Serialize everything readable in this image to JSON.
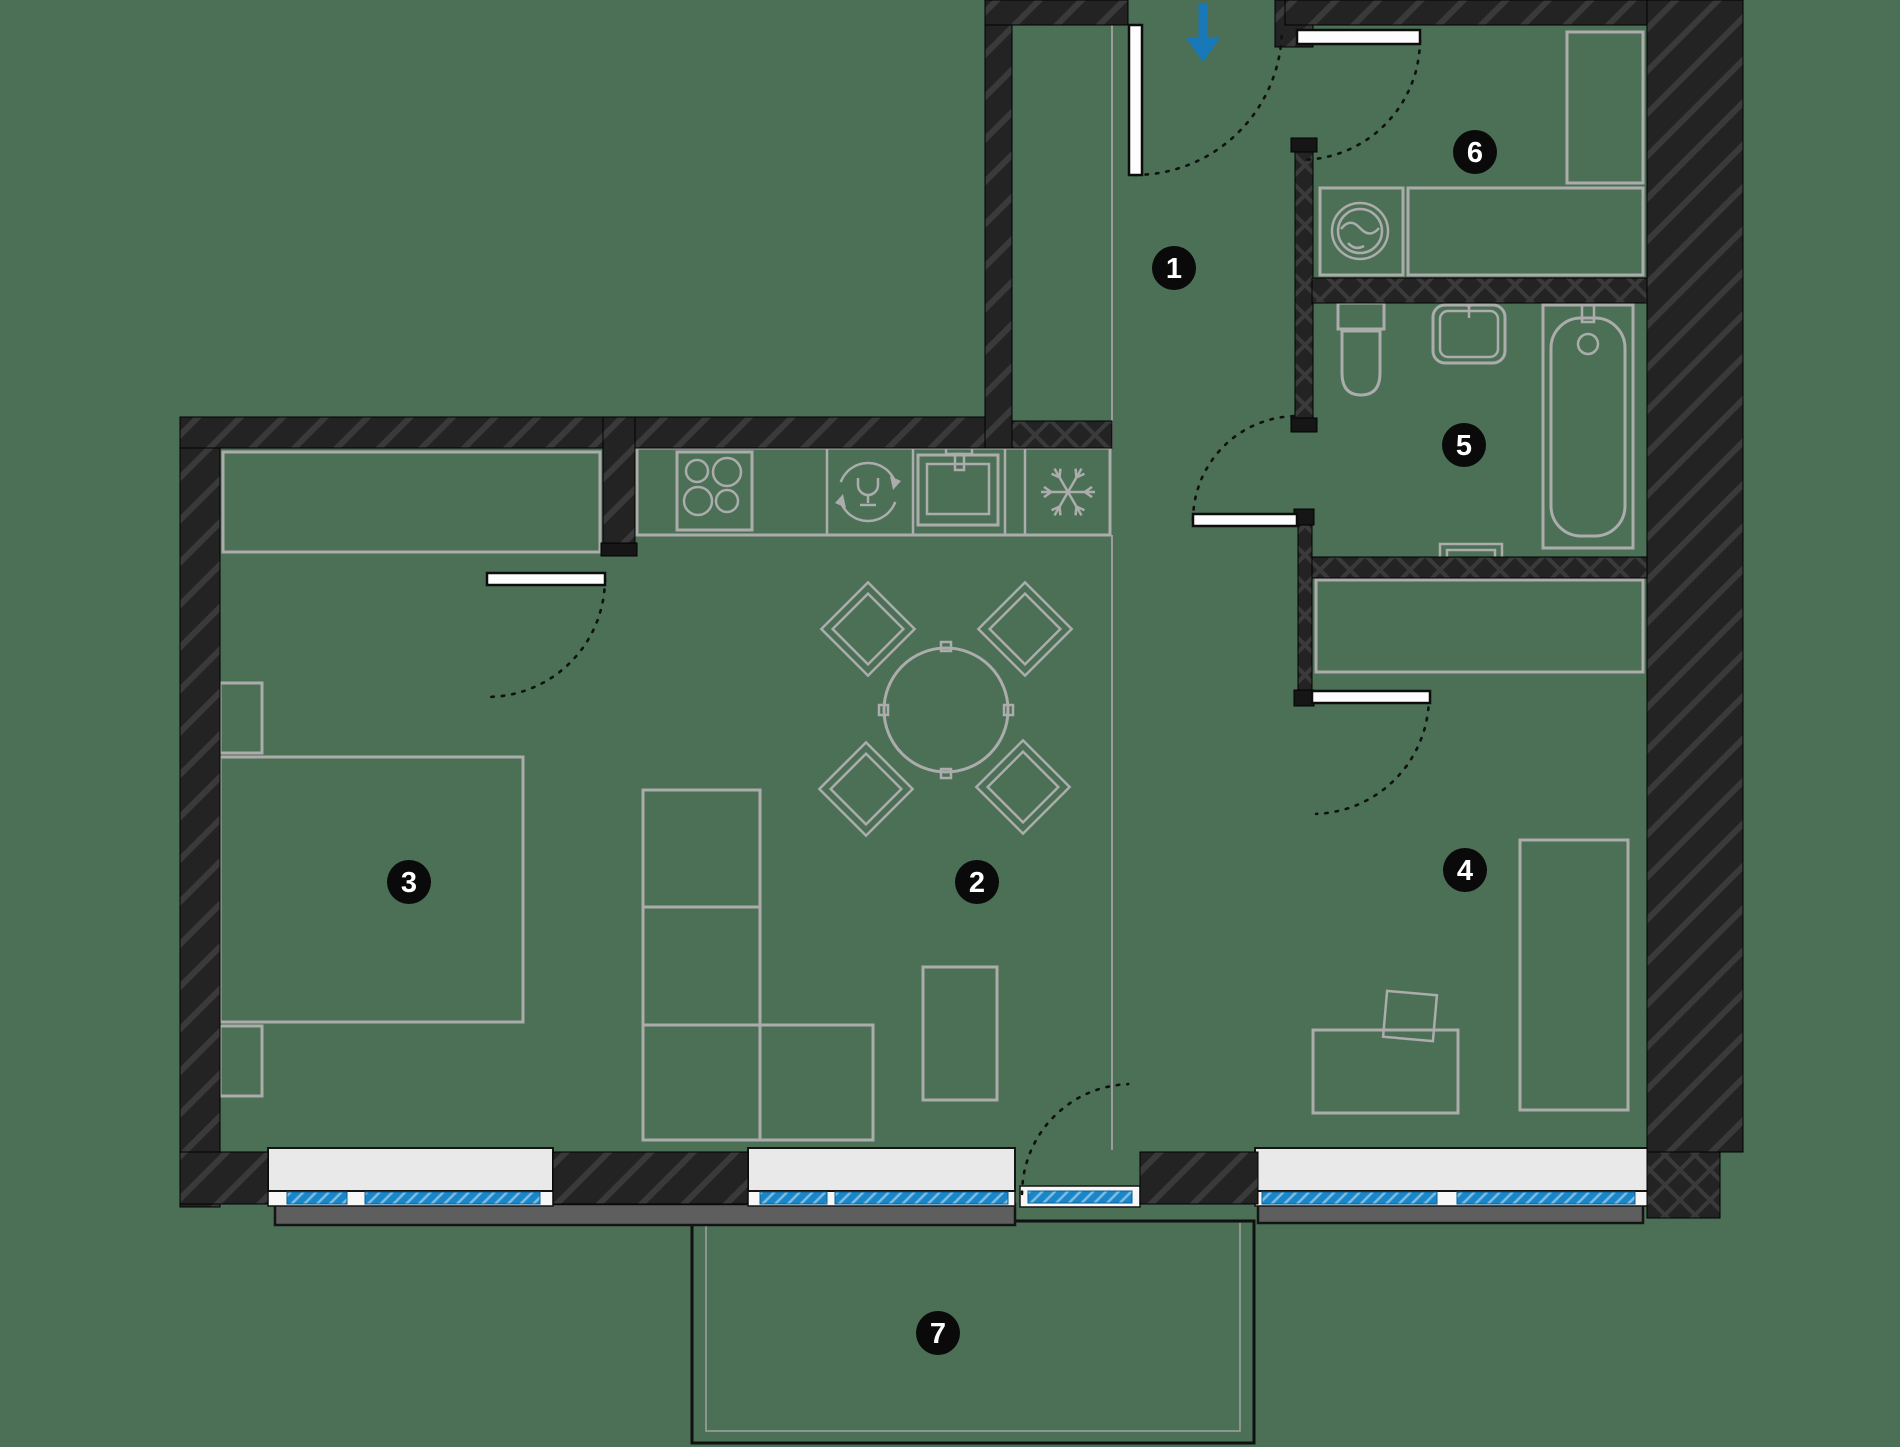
{
  "canvas": {
    "width": 1900,
    "height": 1447,
    "background": "#4b7056"
  },
  "palette": {
    "floor": "#4b7056",
    "wall": "#232323",
    "wall_hatch": "#3a3a3a",
    "furniture": "#abacab",
    "glass_blue": "#1886c9",
    "sill_inner": "#e9e9e9",
    "sill_outer": "#5e5e5e",
    "badge": "#0a0a0a",
    "badge_text": "#ffffff",
    "arrow_blue": "#1878b8"
  },
  "badges": [
    {
      "label": "1",
      "x": 1174,
      "y": 268
    },
    {
      "label": "2",
      "x": 977,
      "y": 882
    },
    {
      "label": "3",
      "x": 409,
      "y": 882
    },
    {
      "label": "4",
      "x": 1465,
      "y": 870
    },
    {
      "label": "5",
      "x": 1464,
      "y": 445
    },
    {
      "label": "6",
      "x": 1475,
      "y": 152
    },
    {
      "label": "7",
      "x": 938,
      "y": 1333
    }
  ],
  "floor_lines": [
    {
      "n": "floor-zone-line",
      "c": "zline",
      "x1": 1112,
      "y1": 25,
      "x2": 1112,
      "y2": 448
    },
    {
      "n": "floor-zone-line",
      "c": "zline",
      "x1": 1112,
      "y1": 535,
      "x2": 1112,
      "y2": 1150
    }
  ],
  "furniture": [
    {
      "n": "wardrobe",
      "c": "furn",
      "x": 223,
      "y": 452,
      "w": 377,
      "h": 100
    },
    {
      "n": "bed",
      "c": "furn",
      "x": 220,
      "y": 757,
      "w": 303,
      "h": 265
    },
    {
      "n": "nightstand",
      "c": "furn",
      "x": 220,
      "y": 683,
      "w": 42,
      "h": 70
    },
    {
      "n": "nightstand",
      "c": "furn",
      "x": 220,
      "y": 1026,
      "w": 42,
      "h": 70
    },
    {
      "n": "kitchen-counter",
      "c": "furn",
      "x": 637,
      "y": 448,
      "w": 473,
      "h": 87
    },
    {
      "n": "counter-divider",
      "c": "furn2",
      "x1": 827,
      "y1": 448,
      "x2": 827,
      "y2": 535
    },
    {
      "n": "counter-divider",
      "c": "furn2",
      "x1": 913,
      "y1": 448,
      "x2": 913,
      "y2": 535
    },
    {
      "n": "counter-divider",
      "c": "furn2",
      "x1": 1005,
      "y1": 448,
      "x2": 1005,
      "y2": 535
    },
    {
      "n": "counter-divider",
      "c": "furn2",
      "x1": 1025,
      "y1": 448,
      "x2": 1025,
      "y2": 535
    },
    {
      "n": "stove",
      "c": "furn",
      "x": 677,
      "y": 452,
      "w": 75,
      "h": 78
    },
    {
      "n": "burner-icon",
      "c": "furn2",
      "cx": 697,
      "cy": 471,
      "r": 11
    },
    {
      "n": "burner-icon",
      "c": "furn2",
      "cx": 727,
      "cy": 472,
      "r": 14
    },
    {
      "n": "burner-icon",
      "c": "furn2",
      "cx": 698,
      "cy": 501,
      "r": 14
    },
    {
      "n": "burner-icon",
      "c": "furn2",
      "cx": 727,
      "cy": 501,
      "r": 11
    },
    {
      "n": "kitchen-sink",
      "c": "furn",
      "x": 918,
      "y": 455,
      "w": 80,
      "h": 70
    },
    {
      "n": "kitchen-sink-basin",
      "c": "furn2",
      "x": 927,
      "y": 464,
      "w": 62,
      "h": 50
    },
    {
      "n": "faucet-icon",
      "c": "furn2",
      "x": 946,
      "y": 446,
      "w": 26,
      "h": 8
    },
    {
      "n": "faucet-icon",
      "c": "furn2",
      "x": 955,
      "y": 454,
      "w": 9,
      "h": 16
    },
    {
      "n": "dining-table",
      "c": "furn",
      "cx": 946,
      "cy": 710,
      "r": 62
    },
    {
      "n": "table-tab",
      "c": "furn2",
      "x": 941,
      "y": 642,
      "w": 10,
      "h": 9
    },
    {
      "n": "table-tab",
      "c": "furn2",
      "x": 941,
      "y": 769,
      "w": 10,
      "h": 9
    },
    {
      "n": "table-tab",
      "c": "furn2",
      "x": 879,
      "y": 705,
      "w": 9,
      "h": 10
    },
    {
      "n": "table-tab",
      "c": "furn2",
      "x": 1004,
      "y": 705,
      "w": 9,
      "h": 10
    },
    {
      "n": "chair",
      "c": "furn2",
      "cx": 868,
      "cy": 629,
      "w": 66,
      "h": 66,
      "rot": 45
    },
    {
      "n": "chair",
      "c": "furn2",
      "cx": 868,
      "cy": 629,
      "w": 50,
      "h": 50,
      "rot": 45
    },
    {
      "n": "chair",
      "c": "furn2",
      "cx": 1025,
      "cy": 629,
      "w": 66,
      "h": 66,
      "rot": 45
    },
    {
      "n": "chair",
      "c": "furn2",
      "cx": 1025,
      "cy": 629,
      "w": 50,
      "h": 50,
      "rot": 45
    },
    {
      "n": "chair",
      "c": "furn2",
      "cx": 866,
      "cy": 789,
      "w": 66,
      "h": 66,
      "rot": 45
    },
    {
      "n": "chair",
      "c": "furn2",
      "cx": 866,
      "cy": 789,
      "w": 50,
      "h": 50,
      "rot": 45
    },
    {
      "n": "chair",
      "c": "furn2",
      "cx": 1023,
      "cy": 787,
      "w": 66,
      "h": 66,
      "rot": 45
    },
    {
      "n": "chair",
      "c": "furn2",
      "cx": 1023,
      "cy": 787,
      "w": 50,
      "h": 50,
      "rot": 45
    },
    {
      "n": "shelf-unit",
      "c": "furn",
      "x": 643,
      "y": 790,
      "w": 117,
      "h": 117
    },
    {
      "n": "shelf-unit",
      "c": "furn",
      "x": 643,
      "y": 907,
      "w": 117,
      "h": 118
    },
    {
      "n": "shelf-unit",
      "c": "furn",
      "x": 643,
      "y": 1025,
      "w": 117,
      "h": 115
    },
    {
      "n": "shelf-unit",
      "c": "furn",
      "x": 760,
      "y": 1025,
      "w": 113,
      "h": 115
    },
    {
      "n": "coffee-table",
      "c": "furn",
      "x": 923,
      "y": 967,
      "w": 74,
      "h": 133
    },
    {
      "n": "washing-machine",
      "c": "furn",
      "x": 1320,
      "y": 188,
      "w": 83,
      "h": 87
    },
    {
      "n": "washing-machine-icon",
      "c": "furn2",
      "cx": 1360,
      "cy": 231,
      "r": 28
    },
    {
      "n": "washing-machine-icon",
      "c": "furn2",
      "cx": 1360,
      "cy": 231,
      "r": 22
    },
    {
      "n": "washer-wave-icon",
      "c": "furn2",
      "d": "M1341,229 Q1350,217 1360,228 Q1370,239 1379,228"
    },
    {
      "n": "washer-wave-icon",
      "c": "furn2",
      "d": "M1348,243 Q1355,251 1364,246"
    },
    {
      "n": "laundry-counter",
      "c": "furn",
      "x": 1408,
      "y": 188,
      "w": 235,
      "h": 87
    },
    {
      "n": "tall-cabinet",
      "c": "furn",
      "x": 1567,
      "y": 32,
      "w": 76,
      "h": 151
    },
    {
      "n": "hall-closet",
      "c": "furn",
      "x": 1316,
      "y": 580,
      "w": 327,
      "h": 92
    },
    {
      "n": "bed",
      "c": "furn",
      "x": 1520,
      "y": 840,
      "w": 108,
      "h": 270
    },
    {
      "n": "desk",
      "c": "furn",
      "x": 1313,
      "y": 1030,
      "w": 145,
      "h": 83
    },
    {
      "n": "desk-chair",
      "c": "furn2",
      "cx": 1410,
      "cy": 1016,
      "w": 50,
      "h": 46,
      "rot": 5
    },
    {
      "n": "bathtub",
      "c": "furn",
      "x": 1543,
      "y": 305,
      "w": 90,
      "h": 243
    },
    {
      "n": "bathtub-basin",
      "c": "furn",
      "x": 1551,
      "y": 318,
      "w": 74,
      "h": 218,
      "rx": 30
    },
    {
      "n": "bathtub-drain-icon",
      "c": "furn2",
      "cx": 1588,
      "cy": 344,
      "r": 10
    },
    {
      "n": "faucet-icon",
      "c": "furn2",
      "x": 1582,
      "y": 302,
      "w": 12,
      "h": 20
    },
    {
      "n": "bathroom-sink",
      "c": "furn",
      "x": 1433,
      "y": 305,
      "w": 72,
      "h": 58,
      "rx": 12
    },
    {
      "n": "bathroom-sink-basin",
      "c": "furn2",
      "x": 1440,
      "y": 311,
      "w": 58,
      "h": 46,
      "rx": 8
    },
    {
      "n": "faucet-icon",
      "c": "furn2",
      "cx": 1469,
      "cy": 301,
      "r": 5
    },
    {
      "n": "faucet-icon",
      "c": "furn2",
      "x1": 1469,
      "y1": 306,
      "x2": 1469,
      "y2": 318
    },
    {
      "n": "toilet-tank",
      "c": "furn",
      "x": 1338,
      "y": 303,
      "w": 46,
      "h": 26
    },
    {
      "n": "toilet-bowl",
      "c": "furn",
      "d": "M1342,331 h38 v42 q0,22 -19,22 q-19,0 -19,-22 Z"
    },
    {
      "n": "towel-radiator",
      "c": "furn2",
      "pts": "1440,557 1440,544 1502,544 1502,557"
    },
    {
      "n": "towel-radiator",
      "c": "furn2",
      "pts": "1447,557 1447,550 1495,550 1495,557"
    }
  ],
  "balcony": [
    {
      "n": "balcony-outline",
      "c": "balA",
      "x": 692,
      "y": 1221,
      "w": 562,
      "h": 222
    },
    {
      "n": "balcony-inner-line",
      "c": "balB",
      "pts": "706,1223 706,1431 1240,1431 1240,1223"
    }
  ],
  "sills_outer": [
    {
      "n": "exterior-sill",
      "c": "sillOut",
      "x": 275,
      "y": 1204,
      "w": 740,
      "h": 21
    },
    {
      "n": "exterior-sill",
      "c": "sillOut",
      "x": 1258,
      "y": 1204,
      "w": 385,
      "h": 19
    }
  ],
  "window_bases": [
    {
      "n": "window-frame",
      "c": "wbase",
      "x": 268,
      "y": 1188,
      "w": 285,
      "h": 18
    },
    {
      "n": "window-frame",
      "c": "wbase",
      "x": 748,
      "y": 1188,
      "w": 267,
      "h": 18
    },
    {
      "n": "window-frame",
      "c": "wbase",
      "x": 1255,
      "y": 1188,
      "w": 393,
      "h": 18
    },
    {
      "n": "balcony-door-frame",
      "c": "wbase",
      "x": 1020,
      "y": 1186,
      "w": 120,
      "h": 21
    }
  ],
  "sills_inner": [
    {
      "n": "window-sill",
      "c": "sillIn",
      "x": 268,
      "y": 1148,
      "w": 285,
      "h": 43
    },
    {
      "n": "window-sill",
      "c": "sillIn",
      "x": 748,
      "y": 1148,
      "w": 267,
      "h": 43
    },
    {
      "n": "window-sill",
      "c": "sillIn",
      "x": 1255,
      "y": 1148,
      "w": 393,
      "h": 43
    }
  ],
  "walls": [
    {
      "n": "exterior-wall-left",
      "c": "wallD",
      "x": 180,
      "y": 417,
      "w": 40,
      "h": 790
    },
    {
      "n": "left-wing-top-wall",
      "c": "wallD",
      "x": 180,
      "y": 417,
      "w": 832,
      "h": 31
    },
    {
      "n": "hall-left-wall",
      "c": "wallD",
      "x": 985,
      "y": 0,
      "w": 27,
      "h": 448
    },
    {
      "n": "entry-top-wall",
      "c": "wallD",
      "x": 985,
      "y": 0,
      "w": 143,
      "h": 25
    },
    {
      "n": "kitchen-top-wall",
      "c": "wallX",
      "x": 1012,
      "y": 421,
      "w": 100,
      "h": 27
    },
    {
      "n": "entry-right-jamb-wall",
      "c": "wallD",
      "x": 1275,
      "y": 0,
      "w": 38,
      "h": 47
    },
    {
      "n": "room6-top-wall",
      "c": "wallD",
      "x": 1285,
      "y": 0,
      "w": 362,
      "h": 25
    },
    {
      "n": "exterior-wall-right",
      "c": "wallD",
      "x": 1647,
      "y": 0,
      "w": 96,
      "h": 1152
    },
    {
      "n": "hall-room6-wall",
      "c": "wallX",
      "x": 1295,
      "y": 150,
      "w": 18,
      "h": 272
    },
    {
      "n": "room6-room5-wall",
      "c": "wallX",
      "x": 1312,
      "y": 278,
      "w": 335,
      "h": 25
    },
    {
      "n": "room5-bottom-wall",
      "c": "wallX",
      "x": 1312,
      "y": 557,
      "w": 335,
      "h": 21
    },
    {
      "n": "hall-closet-wall",
      "c": "wallX",
      "x": 1298,
      "y": 523,
      "w": 14,
      "h": 169
    },
    {
      "n": "kitchen-room3-wall",
      "c": "wallD",
      "x": 603,
      "y": 417,
      "w": 32,
      "h": 130
    },
    {
      "n": "bottom-wall-left",
      "c": "wallD",
      "x": 180,
      "y": 1152,
      "w": 88,
      "h": 52
    },
    {
      "n": "bottom-wall-mid",
      "c": "wallD",
      "x": 553,
      "y": 1152,
      "w": 195,
      "h": 52
    },
    {
      "n": "bottom-wall-hall",
      "c": "wallD",
      "x": 1140,
      "y": 1152,
      "w": 118,
      "h": 52
    },
    {
      "n": "bottom-wall-right-corner",
      "c": "wallX",
      "x": 1647,
      "y": 1152,
      "w": 73,
      "h": 66
    }
  ],
  "jambs": [
    {
      "n": "door-jamb",
      "c": "jamb",
      "x": 1291,
      "y": 138,
      "w": 26,
      "h": 14
    },
    {
      "n": "door-jamb",
      "c": "jamb",
      "x": 1291,
      "y": 418,
      "w": 26,
      "h": 14
    },
    {
      "n": "door-jamb",
      "c": "jamb",
      "x": 1294,
      "y": 509,
      "w": 20,
      "h": 16
    },
    {
      "n": "door-jamb",
      "c": "jamb",
      "x": 1294,
      "y": 690,
      "w": 20,
      "h": 16
    },
    {
      "n": "door-jamb",
      "c": "jamb",
      "x": 601,
      "y": 543,
      "w": 36,
      "h": 13
    }
  ],
  "glass": [
    {
      "n": "window-glass",
      "c": "glass",
      "x": 287,
      "y": 1192,
      "w": 60,
      "h": 12
    },
    {
      "n": "window-glass",
      "c": "glass",
      "x": 365,
      "y": 1192,
      "w": 175,
      "h": 12
    },
    {
      "n": "window-glass",
      "c": "glass",
      "x": 760,
      "y": 1192,
      "w": 67,
      "h": 12
    },
    {
      "n": "window-glass",
      "c": "glass",
      "x": 835,
      "y": 1192,
      "w": 173,
      "h": 12
    },
    {
      "n": "window-glass",
      "c": "glass",
      "x": 1262,
      "y": 1192,
      "w": 175,
      "h": 12
    },
    {
      "n": "window-glass",
      "c": "glass",
      "x": 1457,
      "y": 1192,
      "w": 178,
      "h": 12
    },
    {
      "n": "balcony-door-glass",
      "c": "glass",
      "x": 1028,
      "y": 1191,
      "w": 104,
      "h": 12
    }
  ],
  "doors_arc": [
    {
      "n": "door-swing-arc",
      "c": "arc",
      "cx": 1135,
      "cy": 28,
      "r": 147,
      "a0": 90,
      "a1": 0
    },
    {
      "n": "door-swing-arc",
      "c": "arc",
      "cx": 1300,
      "cy": 40,
      "r": 120,
      "a0": 0,
      "a1": 90
    },
    {
      "n": "door-swing-arc",
      "c": "arc",
      "cx": 1297,
      "cy": 520,
      "r": 104,
      "a0": 180,
      "a1": 270
    },
    {
      "n": "door-swing-arc",
      "c": "arc",
      "cx": 1312,
      "cy": 697,
      "r": 117,
      "a0": 0,
      "a1": 90
    },
    {
      "n": "door-swing-arc",
      "c": "arc",
      "cx": 487,
      "cy": 579,
      "r": 118,
      "a0": 0,
      "a1": 90
    },
    {
      "n": "door-swing-arc",
      "c": "arc",
      "cx": 1132,
      "cy": 1194,
      "r": 110,
      "a0": 180,
      "a1": 270
    }
  ],
  "doors_leaf": [
    {
      "n": "entrance-door-leaf",
      "c": "leaf",
      "x": 1129,
      "y": 25,
      "w": 13,
      "h": 150
    },
    {
      "n": "room6-door-leaf",
      "c": "leaf",
      "x": 1297,
      "y": 30,
      "w": 123,
      "h": 14
    },
    {
      "n": "room5-door-leaf",
      "c": "leaf",
      "x": 1193,
      "y": 514,
      "w": 104,
      "h": 12
    },
    {
      "n": "room4-door-leaf",
      "c": "leaf",
      "x": 1312,
      "y": 691,
      "w": 118,
      "h": 12
    },
    {
      "n": "room3-door-leaf",
      "c": "leaf",
      "x": 487,
      "y": 573,
      "w": 118,
      "h": 12
    }
  ],
  "icons": [
    {
      "n": "snowflake-icon",
      "c": "furn2",
      "type": "snowflake",
      "cx": 1068,
      "cy": 492,
      "r": 27
    },
    {
      "n": "dishwasher-icon",
      "c": "furn2",
      "cx": 868,
      "cy": 492,
      "r": 29,
      "a0": -160,
      "a1": -20
    },
    {
      "n": "dishwasher-icon",
      "c": "furn2",
      "cx": 868,
      "cy": 492,
      "r": 29,
      "a0": 20,
      "a1": 160
    },
    {
      "n": "dishwasher-arrow-icon",
      "c": "grayfill",
      "pts": "890,476 901,481 893,490",
      "closed": true
    },
    {
      "n": "dishwasher-arrow-icon",
      "c": "grayfill",
      "pts": "846,508 835,503 843,494",
      "closed": true
    },
    {
      "n": "wine-glass-icon",
      "c": "furn2",
      "d": "M858,478 v7 a10,10 0 0 0 20,0 v-7"
    },
    {
      "n": "wine-glass-icon",
      "c": "furn2",
      "x1": 868,
      "y1": 495,
      "x2": 868,
      "y2": 503
    },
    {
      "n": "wine-glass-icon",
      "c": "furn2",
      "x1": 860,
      "y1": 505,
      "x2": 876,
      "y2": 505
    }
  ],
  "entrance_arrow": {
    "n": "entrance-arrow-icon",
    "shaft": {
      "x1": 1203,
      "y1": 4,
      "x2": 1203,
      "y2": 40
    },
    "head": "1186,38 1220,38 1203,62"
  }
}
